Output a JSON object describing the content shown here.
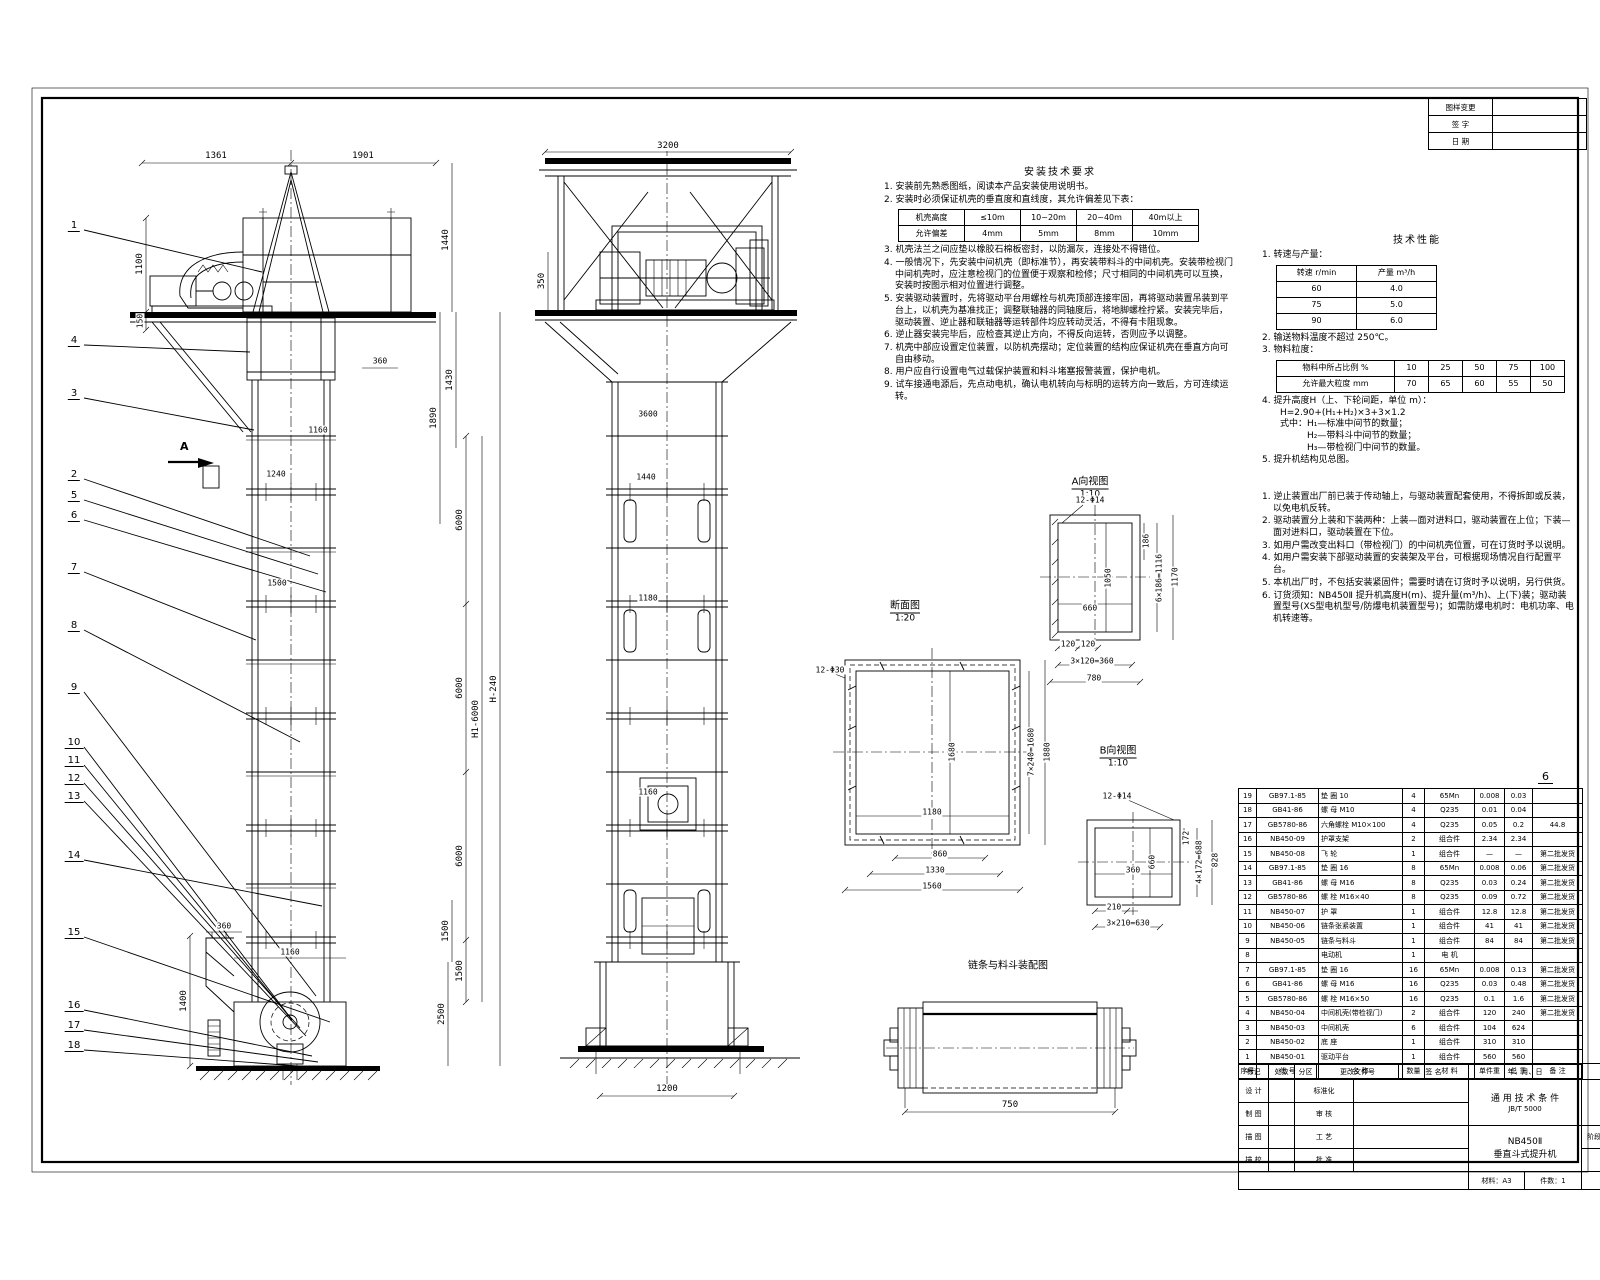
{
  "sheet": {
    "page_number": "6"
  },
  "revision_table": {
    "rows": [
      [
        "图样变更",
        ""
      ],
      [
        "签  字",
        ""
      ],
      [
        "日  期",
        ""
      ]
    ]
  },
  "balloons": [
    "1",
    "4",
    "3",
    "2",
    "5",
    "6",
    "7",
    "8",
    "9",
    "10",
    "11",
    "12",
    "13",
    "14",
    "15",
    "16",
    "17",
    "18"
  ],
  "views": {
    "front": {
      "section_label": "A",
      "dims": [
        "1361",
        "1901",
        "1100",
        "150",
        "1440",
        "1890",
        "1430",
        "360",
        "1160",
        "1240",
        "1500",
        "6000",
        "6000",
        "6000",
        "1500",
        "H1-6000",
        "H-240",
        "1400",
        "360",
        "1160",
        "1500",
        "2500"
      ]
    },
    "side": {
      "dims": [
        "3200",
        "350",
        "3600",
        "1440",
        "1180",
        "1160",
        "1200"
      ]
    },
    "view_a": {
      "label": "A向视图",
      "scale": "1:10",
      "dims": [
        "12-Φ14",
        "186",
        "1050",
        "660",
        "6×186=1116",
        "1170",
        "120",
        "120",
        "3×120=360",
        "780"
      ]
    },
    "section_aa": {
      "label": "断面图",
      "scale": "1:20",
      "dims": [
        "12-Φ30",
        "1680",
        "7×240=1680",
        "1880",
        "1180",
        "860",
        "1330",
        "1560"
      ]
    },
    "view_b": {
      "label": "B向视图",
      "scale": "1:10",
      "dims": [
        "12-Φ14",
        "172",
        "4×172=688",
        "828",
        "660",
        "360",
        "210",
        "3×210=630"
      ]
    },
    "drum": {
      "label": "链条与料斗装配图",
      "dim": "750"
    }
  },
  "install_notes": {
    "title": "安装技术要求",
    "items_a": [
      "1. 安装前先熟悉图纸，阅读本产品安装使用说明书。",
      "2. 安装时必须保证机壳的垂直度和直线度，其允许偏差见下表："
    ],
    "table": [
      [
        "机壳高度",
        "≤10m",
        "10~20m",
        "20~40m",
        "40m以上"
      ],
      [
        "允许偏差",
        "4mm",
        "5mm",
        "8mm",
        "10mm"
      ]
    ],
    "items_b": [
      "3. 机壳法兰之间应垫以橡胶石棉板密封，以防漏灰，连接处不得错位。",
      "4. 一般情况下，先安装中间机壳（即标准节），再安装带料斗的中间机壳。安装带检视门中间机壳时，应注意检视门的位置便于观察和检修；尺寸相同的中间机壳可以互换，安装时按图示相对位置进行调整。",
      "5. 安装驱动装置时，先将驱动平台用螺栓与机壳顶部连接牢固，再将驱动装置吊装到平台上，以机壳为基准找正；调整联轴器的同轴度后，将地脚螺栓拧紧。安装完毕后，驱动装置、逆止器和联轴器等运转部件均应转动灵活，不得有卡阻现象。",
      "6. 逆止器安装完毕后，应检查其逆止方向，不得反向运转，否则应予以调整。",
      "7. 机壳中部应设置定位装置，以防机壳摆动；定位装置的结构应保证机壳在垂直方向可自由移动。",
      "8. 用户应自行设置电气过载保护装置和料斗堵塞报警装置，保护电机。",
      "9. 试车接通电源后，先点动电机，确认电机转向与标明的运转方向一致后，方可连续运转。"
    ]
  },
  "tech": {
    "title": "技术性能",
    "i1": "1. 转速与产量：",
    "speed_table": [
      [
        "转速 r/min",
        "产量 m³/h"
      ],
      [
        "60",
        "4.0"
      ],
      [
        "75",
        "5.0"
      ],
      [
        "90",
        "6.0"
      ]
    ],
    "i2": "2. 输送物料温度不超过 250℃。",
    "i3": "3. 物料粒度：",
    "size_table": [
      [
        "物料中所占比例 %",
        "10",
        "25",
        "50",
        "75",
        "100"
      ],
      [
        "允许最大粒度 mm",
        "70",
        "65",
        "60",
        "55",
        "50"
      ]
    ],
    "formula": [
      "4. 提升高度H（上、下轮间距，单位 m）：",
      "　　H=2.90+(H₁+H₂)×3+3×1.2",
      "　　式中：H₁—标准中间节的数量；",
      "　　　　　H₂—带料斗中间节的数量；",
      "　　　　　H₃—带检视门中间节的数量。",
      "5. 提升机结构见总图。"
    ]
  },
  "usage_notes": {
    "items": [
      "1. 逆止装置出厂前已装于传动轴上，与驱动装置配套使用，不得拆卸或反装，以免电机反转。",
      "2. 驱动装置分上装和下装两种：上装—面对进料口，驱动装置在上位；下装—面对进料口，驱动装置在下位。",
      "3. 如用户需改变出料口（带检视门）的中间机壳位置，可在订货时予以说明。",
      "4. 如用户需安装下部驱动装置的安装架及平台，可根据现场情况自行配置平台。",
      "5. 本机出厂时，不包括安装紧固件；需要时请在订货时予以说明，另行供货。",
      "6. 订货须知：NB450Ⅱ 提升机高度H(m)、提升量(m³/h)、上(下)装；驱动装置型号(XS型电机型号/防爆电机装置型号)；如需防爆电机时：电机功率、电机转速等。"
    ]
  },
  "parts_list": {
    "header": [
      "序号",
      "代  号",
      "名  称",
      "数量",
      "材  料",
      "单件重",
      "总 重",
      "备 注"
    ],
    "rows": [
      [
        "19",
        "GB97.1-85",
        "垫  圈  10",
        "4",
        "65Mn",
        "0.008",
        "0.03",
        ""
      ],
      [
        "18",
        "GB41-86",
        "螺  母  M10",
        "4",
        "Q235",
        "0.01",
        "0.04",
        ""
      ],
      [
        "17",
        "GB5780-86",
        "六角螺栓 M10×100",
        "4",
        "Q235",
        "0.05",
        "0.2",
        "44.8"
      ],
      [
        "16",
        "NB450-09",
        "护罩支架",
        "2",
        "组合件",
        "2.34",
        "2.34",
        ""
      ],
      [
        "15",
        "NB450-08",
        "飞  轮",
        "1",
        "组合件",
        "—",
        "—",
        "第二批发货"
      ],
      [
        "14",
        "GB97.1-85",
        "垫  圈  16",
        "8",
        "65Mn",
        "0.008",
        "0.06",
        "第二批发货"
      ],
      [
        "13",
        "GB41-86",
        "螺  母  M16",
        "8",
        "Q235",
        "0.03",
        "0.24",
        "第二批发货"
      ],
      [
        "12",
        "GB5780-86",
        "螺  栓  M16×40",
        "8",
        "Q235",
        "0.09",
        "0.72",
        "第二批发货"
      ],
      [
        "11",
        "NB450-07",
        "护  罩",
        "1",
        "组合件",
        "12.8",
        "12.8",
        "第二批发货"
      ],
      [
        "10",
        "NB450-06",
        "链条张紧装置",
        "1",
        "组合件",
        "41",
        "41",
        "第二批发货"
      ],
      [
        "9",
        "NB450-05",
        "链条与料斗",
        "1",
        "组合件",
        "84",
        "84",
        "第二批发货"
      ],
      [
        "8",
        "",
        "电动机",
        "1",
        "电 机",
        "",
        "",
        " "
      ],
      [
        "7",
        "GB97.1-85",
        "垫  圈  16",
        "16",
        "65Mn",
        "0.008",
        "0.13",
        "第二批发货"
      ],
      [
        "6",
        "GB41-86",
        "螺  母  M16",
        "16",
        "Q235",
        "0.03",
        "0.48",
        "第二批发货"
      ],
      [
        "5",
        "GB5780-86",
        "螺  栓  M16×50",
        "16",
        "Q235",
        "0.1",
        "1.6",
        "第二批发货"
      ],
      [
        "4",
        "NB450-04",
        "中间机壳(带检视门)",
        "2",
        "组合件",
        "120",
        "240",
        "第二批发货"
      ],
      [
        "3",
        "NB450-03",
        "中间机壳",
        "6",
        "组合件",
        "104",
        "624",
        ""
      ],
      [
        "2",
        "NB450-02",
        "底  座",
        "1",
        "组合件",
        "310",
        "310",
        ""
      ],
      [
        "1",
        "NB450-01",
        "驱动平台",
        "1",
        "组合件",
        "560",
        "560",
        ""
      ]
    ]
  },
  "title_block": {
    "mark_row": [
      "标记",
      "处数",
      "分区",
      "更改文件号",
      "签 名",
      "年、月、日"
    ],
    "sig_rows": [
      [
        "设 计",
        "标准化"
      ],
      [
        "制 图",
        "审 核"
      ],
      [
        "描 图",
        "工 艺"
      ],
      [
        "描 校",
        "批 准"
      ]
    ],
    "spec_title": "通 用 技 术 条 件",
    "spec_code": "JB/T 5000",
    "drawing_no": "NB450Ⅱ-00",
    "product_model": "NB450Ⅱ",
    "product_name": "垂直斗式提升机",
    "material": "材料：A3",
    "qty": "件数：1",
    "stage_label": "阶段标记",
    "mass_label": "质量",
    "scale_label": "比例",
    "sheets_label": "共  张",
    "sheet_label": "第  张"
  }
}
